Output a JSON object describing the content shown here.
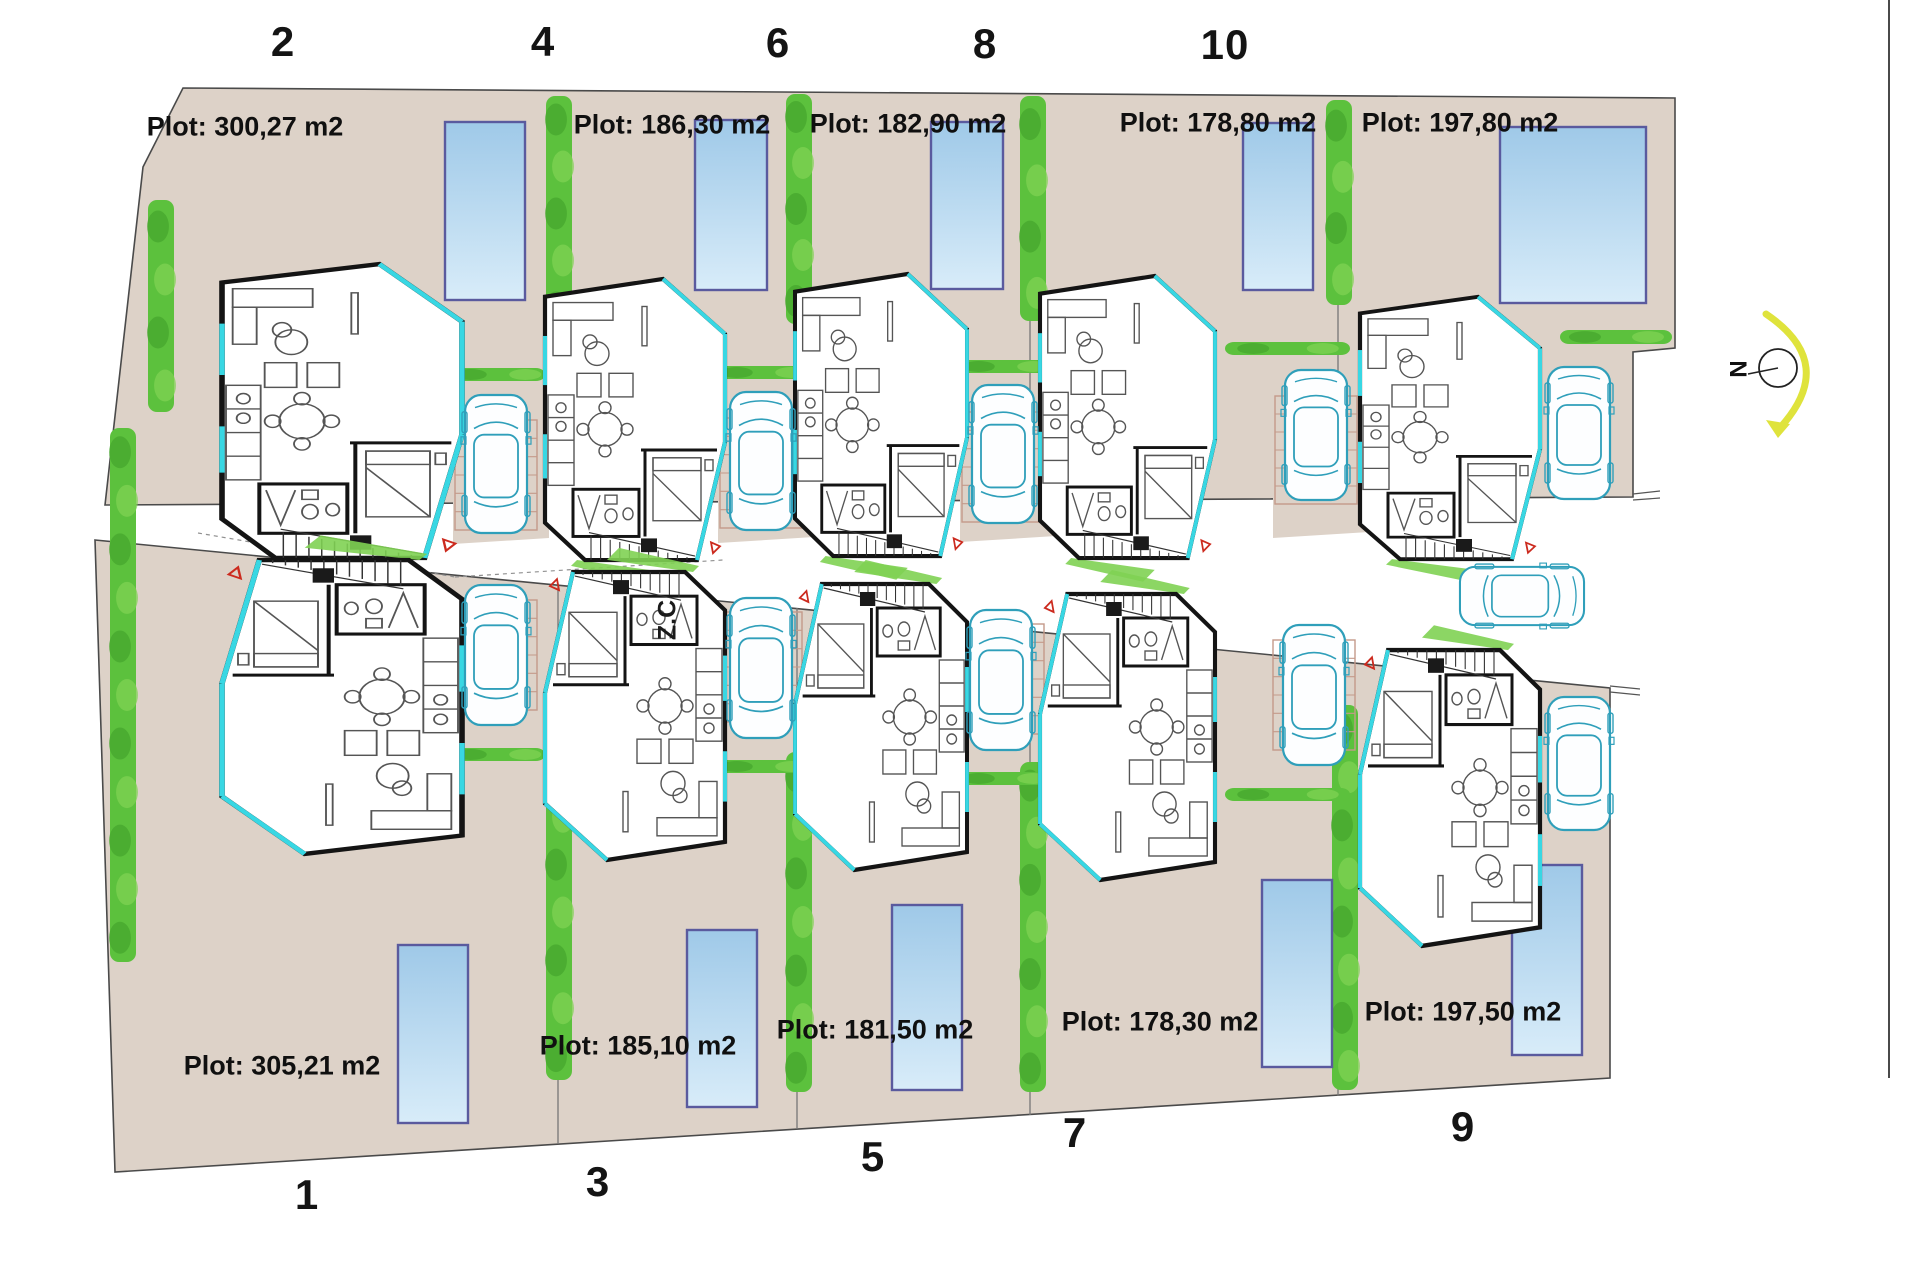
{
  "title": "Residential plots site plan",
  "street": {
    "label": "Z.C",
    "pos": [
      668,
      620
    ],
    "car": {
      "cx": 1522,
      "cy": 596,
      "scale": 0.94
    }
  },
  "compass": {
    "label": "N",
    "label_pos": [
      1737,
      369
    ],
    "center": [
      1778,
      368
    ],
    "radius": 19
  },
  "colors": {
    "ground": "#ddd2c8",
    "outline": "#4a4a4a",
    "wall": "#141414",
    "glass": "#38d7e3",
    "pool_border": "#5a5a9e",
    "pool_top": "#9fc9e8",
    "pool_bottom": "#d8ecf9",
    "hedge": "#5cc13d",
    "hedge_light": "#7fd153",
    "hedge_dark": "#46a52e",
    "car": "#2f9fba",
    "parking": "#c49a8a",
    "marker": "#cc2a1e",
    "compass_arrow": "#dfe33c",
    "furniture": "#555555"
  },
  "plots": [
    {
      "number": "2",
      "area_label": "Plot: 300,27 m2",
      "row": "top",
      "number_pos": [
        283,
        42
      ],
      "label_pos": [
        245,
        127
      ],
      "pool": [
        445,
        122,
        80,
        178
      ],
      "house": [
        222,
        262,
        240,
        298
      ]
    },
    {
      "number": "4",
      "area_label": "Plot: 186,30 m2",
      "row": "top",
      "number_pos": [
        543,
        42
      ],
      "label_pos": [
        672,
        125
      ],
      "pool": [
        695,
        120,
        72,
        170
      ],
      "house": [
        545,
        277,
        180,
        285
      ]
    },
    {
      "number": "6",
      "area_label": "Plot: 182,90 m2",
      "row": "top",
      "number_pos": [
        778,
        43
      ],
      "label_pos": [
        908,
        124
      ],
      "pool": [
        931,
        122,
        72,
        167
      ],
      "house": [
        795,
        272,
        172,
        286
      ]
    },
    {
      "number": "8",
      "area_label": "Plot: 178,80 m2",
      "row": "top",
      "number_pos": [
        985,
        44
      ],
      "label_pos": [
        1218,
        123
      ],
      "pool": [
        1243,
        123,
        70,
        167
      ],
      "house": [
        1040,
        274,
        175,
        286
      ]
    },
    {
      "number": "10",
      "area_label": "Plot: 197,80 m2",
      "row": "top",
      "number_pos": [
        1225,
        45
      ],
      "label_pos": [
        1460,
        123
      ],
      "pool": [
        1500,
        127,
        146,
        176
      ],
      "house": [
        1360,
        295,
        180,
        266
      ]
    },
    {
      "number": "1",
      "area_label": "Plot: 305,21 m2",
      "row": "bottom",
      "number_pos": [
        307,
        1195
      ],
      "label_pos": [
        282,
        1066
      ],
      "pool": [
        398,
        945,
        70,
        178
      ],
      "house": [
        222,
        558,
        240,
        298
      ]
    },
    {
      "number": "3",
      "area_label": "Plot: 185,10 m2",
      "row": "bottom",
      "number_pos": [
        598,
        1182
      ],
      "label_pos": [
        638,
        1046
      ],
      "pool": [
        687,
        930,
        70,
        177
      ],
      "house": [
        545,
        570,
        180,
        292
      ]
    },
    {
      "number": "5",
      "area_label": "Plot: 181,50 m2",
      "row": "bottom",
      "number_pos": [
        873,
        1157
      ],
      "label_pos": [
        875,
        1030
      ],
      "pool": [
        892,
        905,
        70,
        185
      ],
      "house": [
        795,
        582,
        172,
        290
      ]
    },
    {
      "number": "7",
      "area_label": "Plot: 178,30 m2",
      "row": "bottom",
      "number_pos": [
        1075,
        1133
      ],
      "label_pos": [
        1160,
        1022
      ],
      "pool": [
        1262,
        880,
        70,
        187
      ],
      "house": [
        1040,
        592,
        175,
        290
      ]
    },
    {
      "number": "9",
      "area_label": "Plot: 197,50 m2",
      "row": "bottom",
      "number_pos": [
        1463,
        1127
      ],
      "label_pos": [
        1463,
        1012
      ],
      "pool": [
        1512,
        865,
        70,
        190
      ],
      "house": [
        1360,
        648,
        180,
        300
      ]
    }
  ],
  "geometry": {
    "top_band": "183,88 1675,98 1675,348 1633,352 1633,497 105,505 143,167",
    "bottom_band": "95,540 1610,688 1610,1078 115,1172",
    "divisions_top": [
      [
        558,
        98,
        500
      ],
      [
        797,
        98,
        500
      ],
      [
        1030,
        99,
        499
      ],
      [
        1338,
        100,
        498
      ]
    ],
    "divisions_bottom": [
      [
        558,
        585,
        1144
      ],
      [
        797,
        608,
        1129
      ],
      [
        1030,
        631,
        1115
      ],
      [
        1338,
        661,
        1096
      ]
    ],
    "forecourt_patches": [
      "453,500 549,500 549,538 453,544",
      "718,500 814,499 814,537 718,543",
      "960,499 1056,498 1056,536 960,542",
      "1273,498 1369,497 1369,532 1273,538"
    ],
    "hedges_v": [
      [
        148,
        200,
        26,
        212
      ],
      [
        110,
        428,
        26,
        534
      ],
      [
        546,
        96,
        26,
        235
      ],
      [
        786,
        94,
        26,
        230
      ],
      [
        1020,
        96,
        26,
        225
      ],
      [
        1326,
        100,
        26,
        205
      ],
      [
        546,
        745,
        26,
        335
      ],
      [
        786,
        752,
        26,
        340
      ],
      [
        1020,
        762,
        26,
        330
      ],
      [
        1332,
        705,
        26,
        385
      ]
    ],
    "hedges_h": [
      [
        450,
        368,
        95,
        13
      ],
      [
        716,
        366,
        95,
        13
      ],
      [
        958,
        360,
        95,
        13
      ],
      [
        1225,
        342,
        125,
        13
      ],
      [
        1560,
        330,
        112,
        14
      ],
      [
        450,
        748,
        95,
        13
      ],
      [
        716,
        760,
        95,
        13
      ],
      [
        958,
        772,
        95,
        13
      ],
      [
        1225,
        788,
        125,
        13
      ]
    ],
    "parking_grids": [
      [
        455,
        420,
        82,
        110
      ],
      [
        720,
        418,
        82,
        110
      ],
      [
        962,
        412,
        82,
        110
      ],
      [
        1275,
        396,
        82,
        108
      ],
      [
        455,
        600,
        82,
        110
      ],
      [
        720,
        612,
        82,
        110
      ],
      [
        962,
        624,
        82,
        110
      ],
      [
        1273,
        640,
        82,
        110
      ]
    ],
    "cars_vertical": [
      [
        465,
        395,
        62,
        138
      ],
      [
        730,
        392,
        62,
        138
      ],
      [
        972,
        385,
        62,
        138
      ],
      [
        1285,
        370,
        62,
        130
      ],
      [
        1548,
        367,
        62,
        132
      ],
      [
        465,
        585,
        62,
        140
      ],
      [
        730,
        598,
        62,
        140
      ],
      [
        970,
        610,
        62,
        140
      ],
      [
        1283,
        625,
        62,
        140
      ],
      [
        1548,
        697,
        62,
        133
      ]
    ],
    "right_line": [
      1889,
      0,
      1889,
      1078
    ],
    "street_dashes": [
      [
        198,
        533,
        455,
        577
      ],
      [
        455,
        577,
        723,
        560
      ]
    ],
    "opening_ticks": [
      [
        1633,
        494,
        1660,
        491
      ],
      [
        1633,
        500,
        1660,
        498
      ],
      [
        1610,
        686,
        1640,
        689
      ],
      [
        1610,
        692,
        1640,
        695
      ]
    ]
  }
}
